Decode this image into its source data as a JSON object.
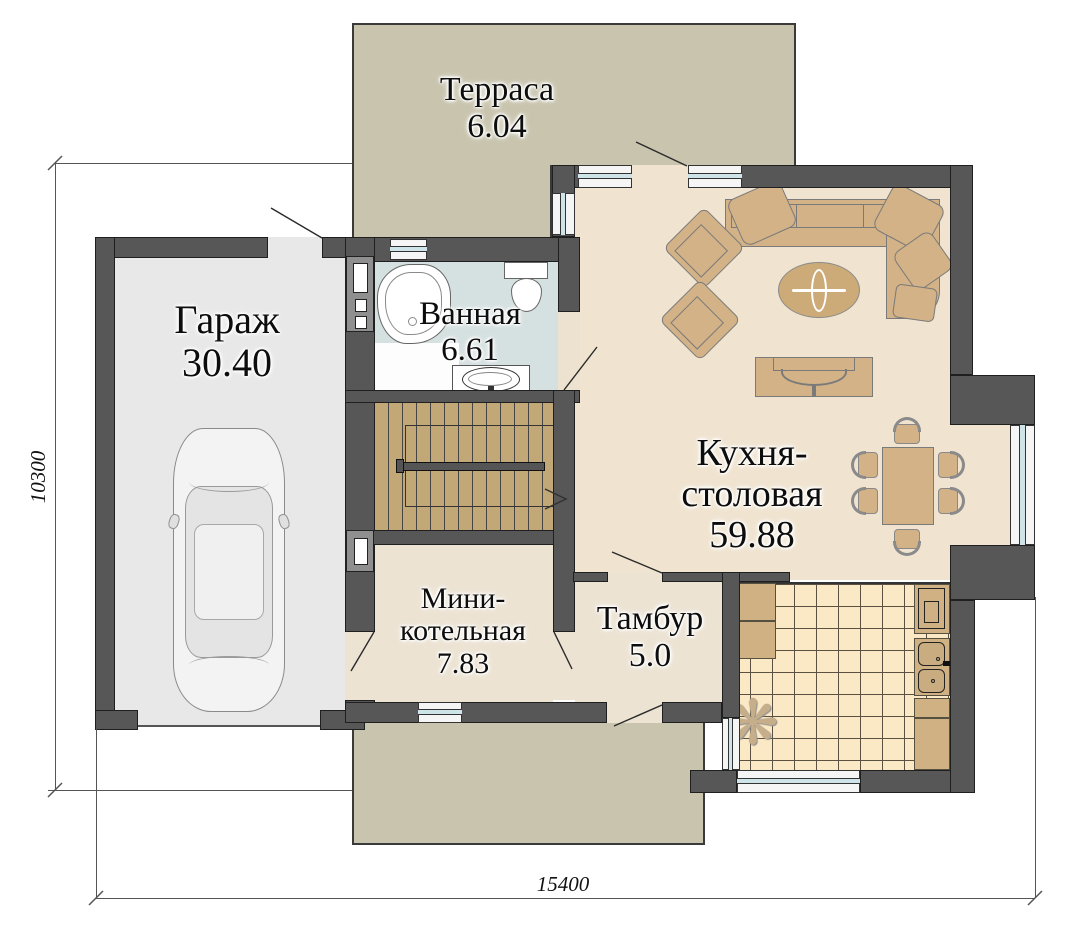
{
  "plan": {
    "title": "house-first-floor-plan",
    "rooms": [
      {
        "id": "terrace",
        "label": "Терраса",
        "area": "6.04"
      },
      {
        "id": "garage",
        "label": "Гараж",
        "area": "30.40"
      },
      {
        "id": "bathroom",
        "label": "Ванная",
        "area": "6.61"
      },
      {
        "id": "kitchen_dining",
        "label_line1": "Кухня-",
        "label_line2": "столовая",
        "area": "59.88"
      },
      {
        "id": "boiler",
        "label_line1": "Мини-",
        "label_line2": "котельная",
        "area": "7.83"
      },
      {
        "id": "vestibule",
        "label": "Тамбур",
        "area": "5.0"
      }
    ],
    "dimensions": {
      "bottom": "15400",
      "left": "10300"
    },
    "colors": {
      "wall": "#575757",
      "terrace": "#c8c4ae",
      "garage_floor": "#e8e8e8",
      "bath_floor": "#d5e0e0",
      "living_floor": "#f0e4d0",
      "service_floor": "#ece3d3",
      "stairs": "#c2a877",
      "tiles": "#fbe8c4",
      "furniture": "#d2b286",
      "window_glass": "#cfe4e9"
    },
    "fixtures": {
      "plant_glyph": "❋"
    }
  }
}
